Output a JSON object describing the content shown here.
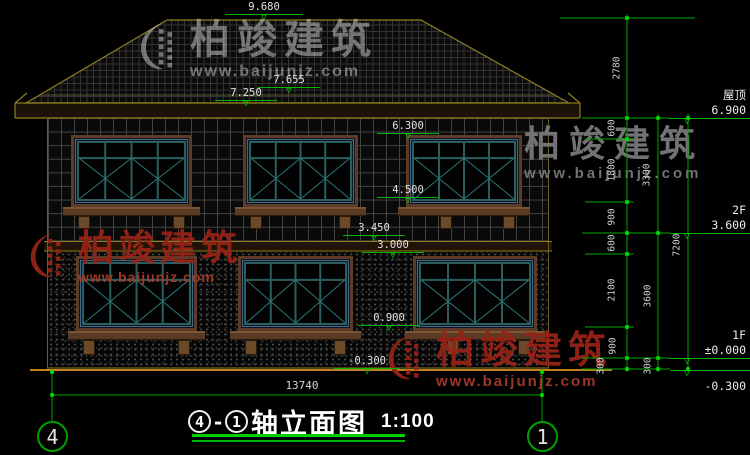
{
  "levels": {
    "ridge": "9.680",
    "upper_eave": "7.655",
    "eave_trim": "7.250",
    "f2_window_head": "6.300",
    "f2_window_sill": "4.500",
    "band": "3.450",
    "f1_window_head": "3.000",
    "f1_window_sill": "0.900",
    "grade": "-0.300",
    "roof_name": "屋顶",
    "roof_level": "6.900",
    "f2_name": "2F",
    "f2_level": "3.600",
    "f1_name": "1F",
    "f1_level": "±0.000",
    "grade_right": "-0.300"
  },
  "dims": {
    "right_inner": [
      "2780",
      "600",
      "1800",
      "900",
      "600",
      "2100",
      "900",
      "300"
    ],
    "right_middle": [
      "3300",
      "3600",
      "300"
    ],
    "right_outer": "7200",
    "total_width": "13740"
  },
  "grid_bubbles": {
    "left": "4",
    "right": "1"
  },
  "titlebar": {
    "bubble_a": "4",
    "dash": "-",
    "bubble_b": "1",
    "name": "轴立面图",
    "scale": "1:100"
  },
  "watermarks": {
    "top": {
      "title": "柏竣建筑",
      "url": "www.baijunjz.com"
    },
    "right": {
      "title": "柏竣建筑",
      "url": "www.baijunjz.com"
    },
    "left": {
      "title": "柏竣建筑",
      "url": "www.baijunjz.com"
    },
    "bottom": {
      "title": "柏竣建筑",
      "url": "www.baijunjz.com"
    }
  }
}
